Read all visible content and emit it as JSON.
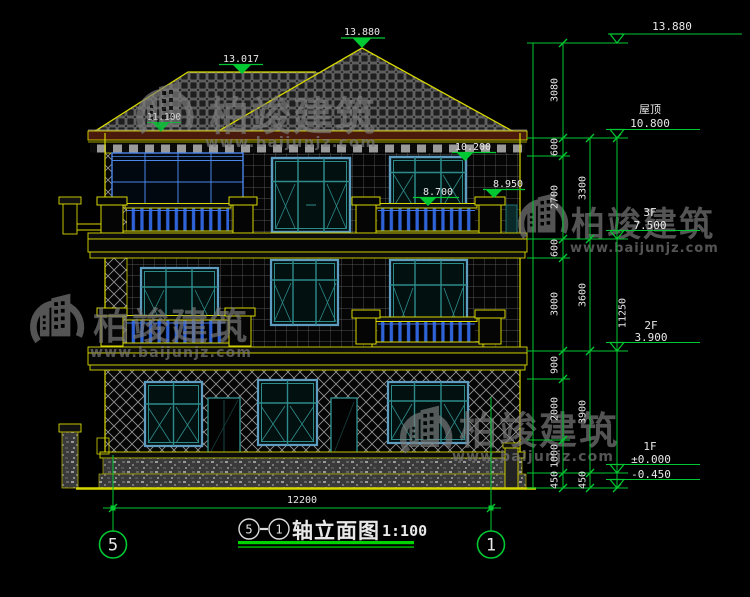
{
  "drawing": {
    "watermark": {
      "name": "柏竣建筑",
      "url": "www.baijunjz.com"
    },
    "levels": {
      "top": "13.880",
      "ridge_left": "13.017",
      "eave_left": "11.100",
      "m10200": "10.200",
      "m8700": "8.700",
      "m8950": "8.950",
      "roof_label": "屋顶",
      "roof": "10.800",
      "f3_label": "3F",
      "f3": "7.500",
      "f2_label": "2F",
      "f2": "3.900",
      "f1_label": "1F",
      "f1": "±0.000",
      "base": "-0.450"
    },
    "dims": {
      "col1": [
        "3080",
        "600",
        "2700",
        "600",
        "3000",
        "900",
        "2000",
        "1000",
        "450"
      ],
      "col2": [
        "3300",
        "3600",
        "3900",
        "450"
      ],
      "total": "11250",
      "width": "12200"
    },
    "axes": {
      "left": "5",
      "right": "1"
    },
    "title": {
      "from": "5",
      "to": "1",
      "text": "轴立面图",
      "scale": "1:100"
    }
  }
}
